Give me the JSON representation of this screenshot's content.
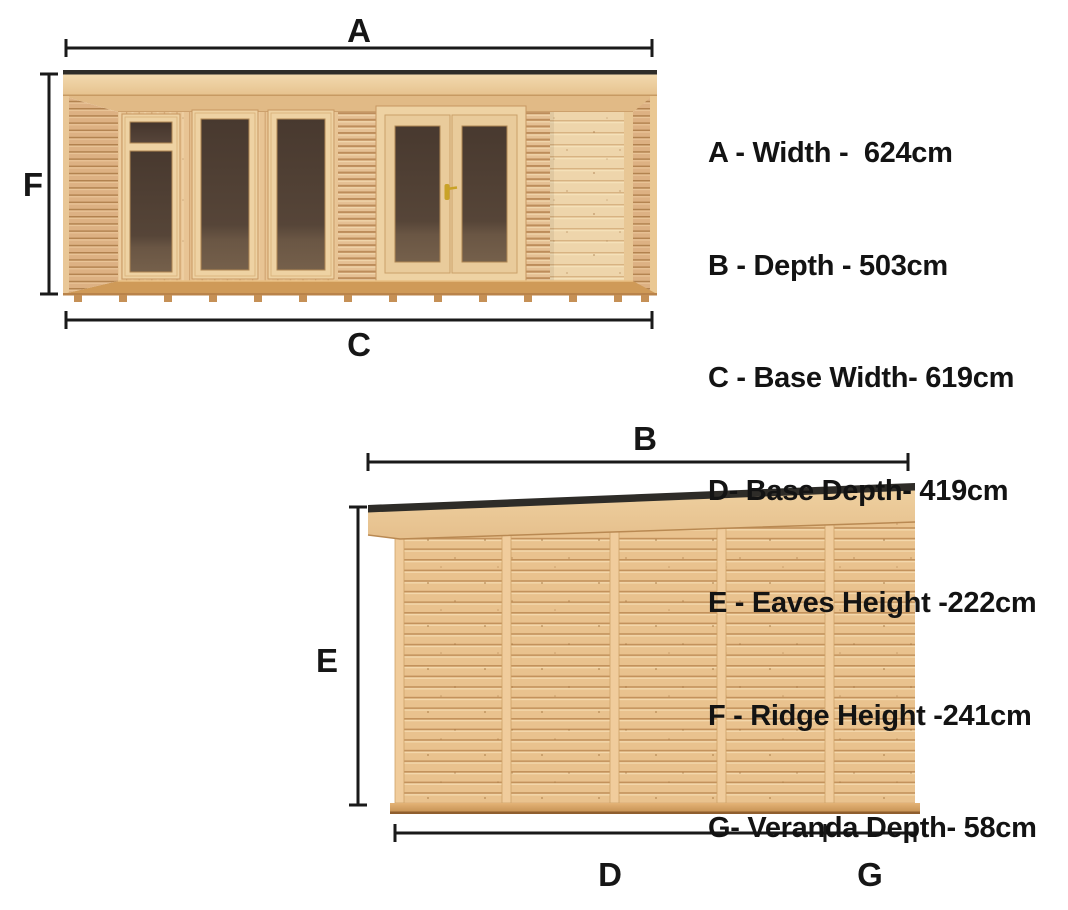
{
  "legend": {
    "items": [
      "A - Width -  624cm",
      "B - Depth - 503cm",
      "C - Base Width- 619cm",
      "D- Base Depth- 419cm",
      "E - Eaves Height -222cm",
      "F - Ridge Height -241cm",
      "G- Veranda Depth- 58cm"
    ]
  },
  "front_view": {
    "label_width": "A",
    "label_ridge_height": "F",
    "label_base_width": "C"
  },
  "side_view": {
    "label_depth": "B",
    "label_eaves_height": "E",
    "label_base_depth": "D",
    "label_veranda_depth": "G"
  },
  "dimensions": [
    {
      "key": "A",
      "name": "Width",
      "value": "624cm"
    },
    {
      "key": "B",
      "name": "Depth",
      "value": "503cm"
    },
    {
      "key": "C",
      "name": "Base Width",
      "value": "619cm"
    },
    {
      "key": "D",
      "name": "Base Depth",
      "value": "419cm"
    },
    {
      "key": "E",
      "name": "Eaves Height",
      "value": "222cm"
    },
    {
      "key": "F",
      "name": "Ridge Height",
      "value": "241cm"
    },
    {
      "key": "G",
      "name": "Veranda Depth",
      "value": "58cm"
    }
  ],
  "colors": {
    "background": "#ffffff",
    "line_and_text": "#1a1a1a",
    "roof_felt_black": "#2e2c28",
    "wood_light": "#f0d6aa",
    "wood_mid": "#e6c192",
    "wood_shadow": "#c79760",
    "deck_base": "#cf9a58",
    "glass_interior_dark": "#48392f",
    "glass_interior_floor": "#75604b",
    "door_handle_gold": "#c9a227"
  }
}
